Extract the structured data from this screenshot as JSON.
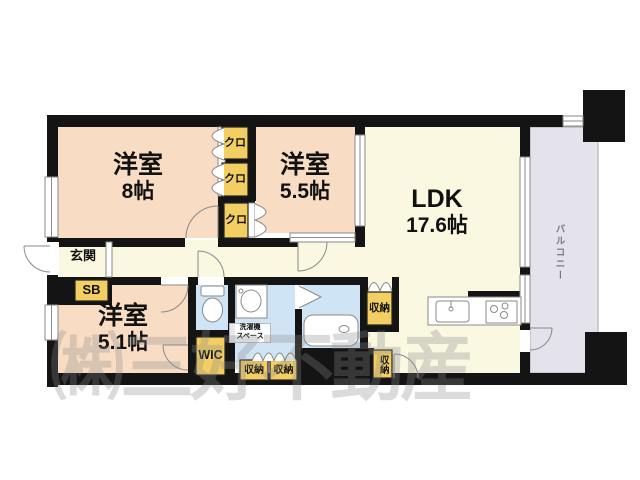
{
  "colors": {
    "wall": "#141414",
    "room": "#f8dcc3",
    "living": "#faf8e1",
    "wet": "#cfe4f4",
    "closet": "#f3cf63",
    "balcony": "#e4e2eb",
    "line": "#8a8a8a",
    "label": "#111111",
    "balLabel": "#777788",
    "wm": "#8a8a8a"
  },
  "rooms": {
    "bedroom_large": {
      "name": "洋室",
      "size": "8帖"
    },
    "bedroom_mid": {
      "name": "洋室",
      "size": "5.5帖"
    },
    "bedroom_small": {
      "name": "洋室",
      "size": "5.1帖"
    },
    "ldk": {
      "name": "LDK",
      "size": "17.6帖"
    },
    "balcony": {
      "label": "バルコニー"
    },
    "entrance": {
      "label": "玄関"
    },
    "shoe_box": {
      "label": "SB"
    },
    "wic": {
      "label": "WIC"
    },
    "laundry": {
      "line1": "洗濯機",
      "line2": "スペース"
    },
    "closets": [
      {
        "label": "クロ"
      },
      {
        "label": "クロ"
      },
      {
        "label": "クロ"
      }
    ],
    "storages": [
      {
        "label": "収納"
      },
      {
        "label": "収納"
      },
      {
        "label": "収納"
      },
      {
        "label": "収納"
      }
    ]
  },
  "watermark": {
    "text": "㈱三好不動産"
  }
}
